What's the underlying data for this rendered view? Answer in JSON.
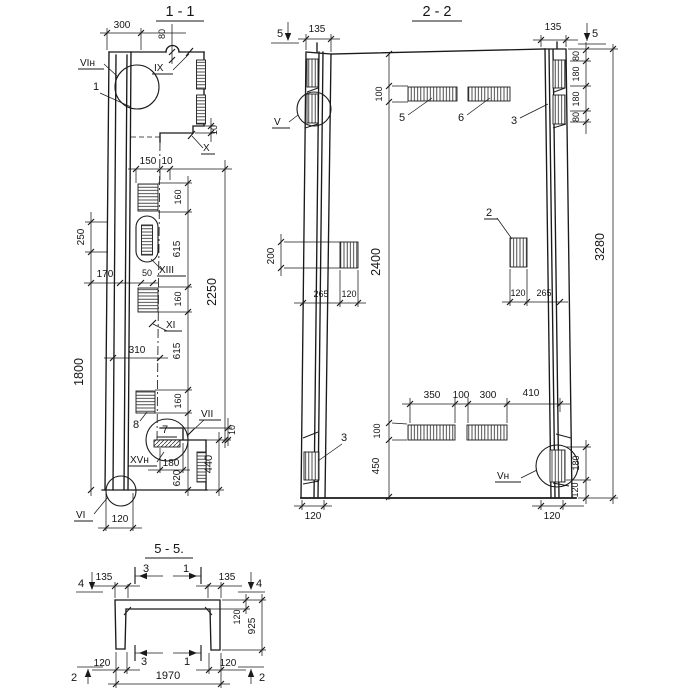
{
  "style": {
    "ink": "#1a1a1a",
    "paper": "#ffffff"
  },
  "s1": {
    "title": "1 - 1",
    "d": {
      "w300": "300",
      "w80": "80",
      "t10top": "10",
      "w150": "150",
      "t10mid": "10",
      "h250": "250",
      "w170": "170",
      "w50": "50",
      "h160a": "160",
      "h615a": "615",
      "h160b": "160",
      "h615b": "615",
      "h160c": "160",
      "h620": "620",
      "h2250": "2250",
      "w310": "310",
      "h1800": "1800",
      "w180": "180",
      "h440": "440",
      "t10bot": "10",
      "w120": "120"
    },
    "l": {
      "vin": "VIн",
      "n1": "1",
      "ix": "IX",
      "x": "X",
      "xiii": "XIII",
      "xi": "XI",
      "n8": "8",
      "n7": "7",
      "vii": "VII",
      "xvn": "XVн",
      "vi": "VI"
    }
  },
  "s2": {
    "title": "2 - 2",
    "d": {
      "w135l": "135",
      "w135r": "135",
      "h80a": "80",
      "h180a": "180",
      "h180b": "180",
      "h80b": "80",
      "h100t": "100",
      "h200": "200",
      "h2400": "2400",
      "h3280": "3280",
      "w265l": "265",
      "w120l": "120",
      "w120r": "120",
      "w265r": "265",
      "w350": "350",
      "w100": "100",
      "w300": "300",
      "w410": "410",
      "h100b": "100",
      "h450": "450",
      "h180r": "180",
      "h120r": "120",
      "w120bl": "120",
      "w120br": "120"
    },
    "l": {
      "cut5l": "5",
      "cut5r": "5",
      "v": "V",
      "n5": "5",
      "n6": "6",
      "n3t": "3",
      "n2": "2",
      "n3b": "3",
      "vn": "Vн"
    }
  },
  "s5": {
    "title": "5 - 5.",
    "d": {
      "w135l": "135",
      "w135r": "135",
      "h120": "120",
      "h925": "925",
      "w120bl": "120",
      "w1970": "1970",
      "w120br": "120"
    },
    "l": {
      "cut4l": "4",
      "cut4r": "4",
      "cut3t": "3",
      "cut1t": "1",
      "cut3b": "3",
      "cut1b": "1",
      "cut2l": "2",
      "cut2r": "2"
    }
  }
}
